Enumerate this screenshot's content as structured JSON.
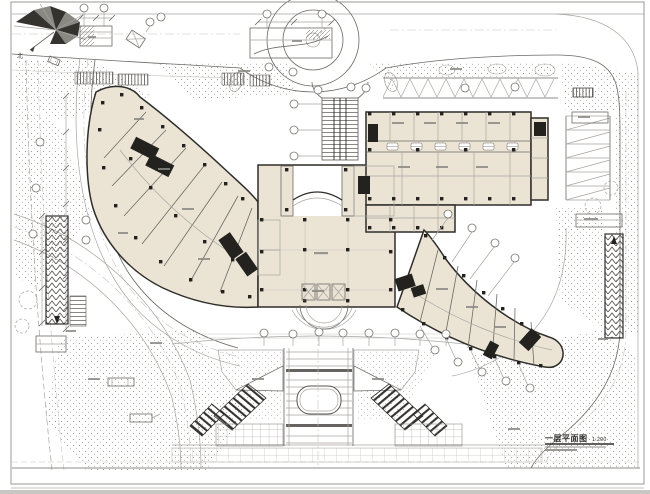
{
  "drawing": {
    "type": "architectural-first-floor-site-plan",
    "title": "一层平面图",
    "scale": "1:200",
    "north_label": "北"
  },
  "palette": {
    "paper": "#ffffff",
    "ink_dark": "#2f2d2a",
    "ink_mid": "#6b6964",
    "ink_light": "#a7a5a0",
    "building_fill": "#ebe4d5",
    "core_fill": "#23221f",
    "stipple_ink": "#8b8984",
    "ground_strip": "#c8c7c3"
  },
  "icons": {
    "wind_rose": "wind-rose-icon",
    "north_arrow": "north-arrow-icon",
    "column_marker": "column-square-icon",
    "axis_bubble": "grid-bubble-icon"
  }
}
